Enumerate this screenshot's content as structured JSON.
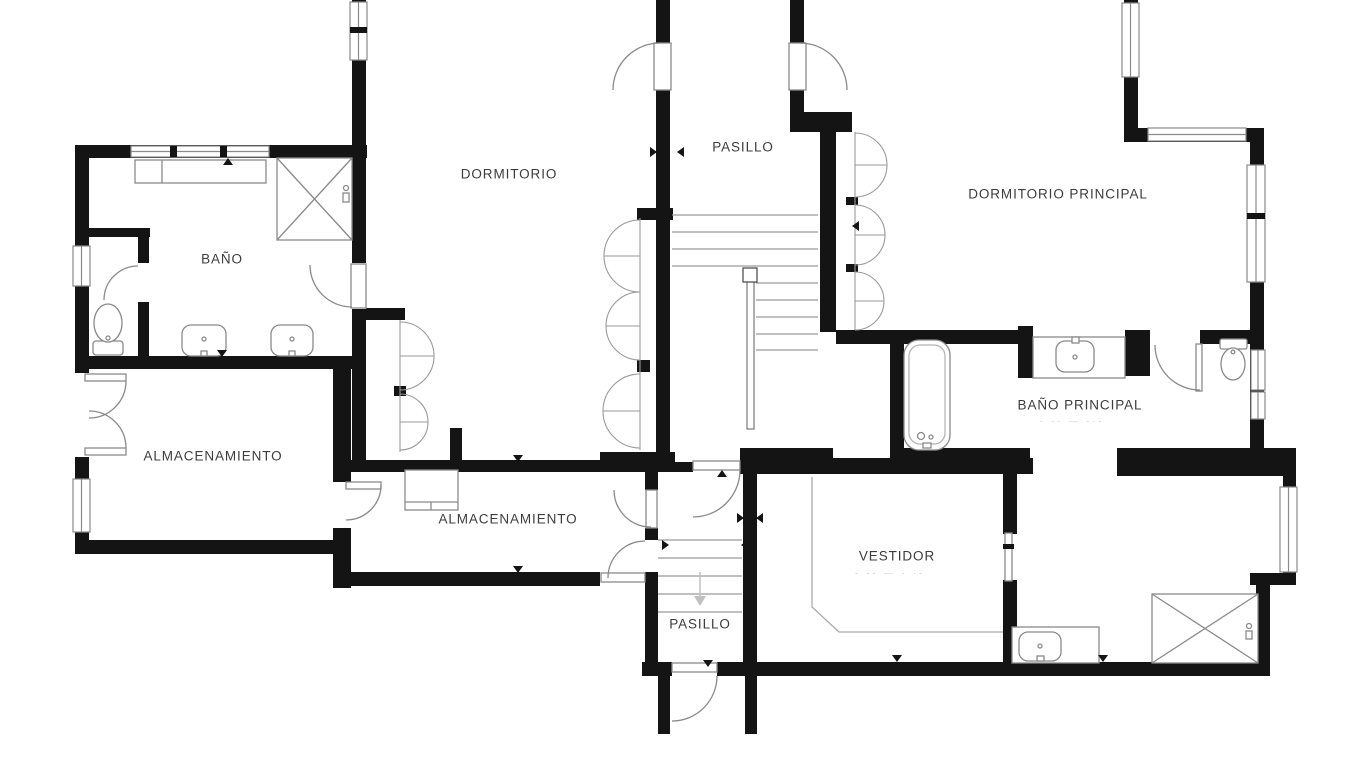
{
  "floor_plan": {
    "rooms": [
      {
        "name": "BAÑO"
      },
      {
        "name": "DORMITORIO"
      },
      {
        "name": "PASILLO"
      },
      {
        "name": "DORMITORIO PRINCIPAL"
      },
      {
        "name": "BAÑO PRINCIPAL",
        "dims": "- --    — -·-"
      },
      {
        "name": "ALMACENAMIENTO"
      },
      {
        "name": "ALMACENAMIENTO"
      },
      {
        "name": "VESTIDOR",
        "dims": "- --   — - ·-"
      },
      {
        "name": "PASILLO"
      }
    ],
    "colors": {
      "wall": "#141414",
      "fixture_line": "#8a8a8a",
      "label_text": "#3c3c3c",
      "faded_dimension_text": "#cccccc",
      "background": "#ffffff"
    },
    "icons": [
      "shower-icon",
      "toilet-icon",
      "sink-icon",
      "bathtub-icon",
      "stairs-icon",
      "door-arc-icon",
      "window-icon",
      "wardrobe-doors-icon"
    ]
  }
}
